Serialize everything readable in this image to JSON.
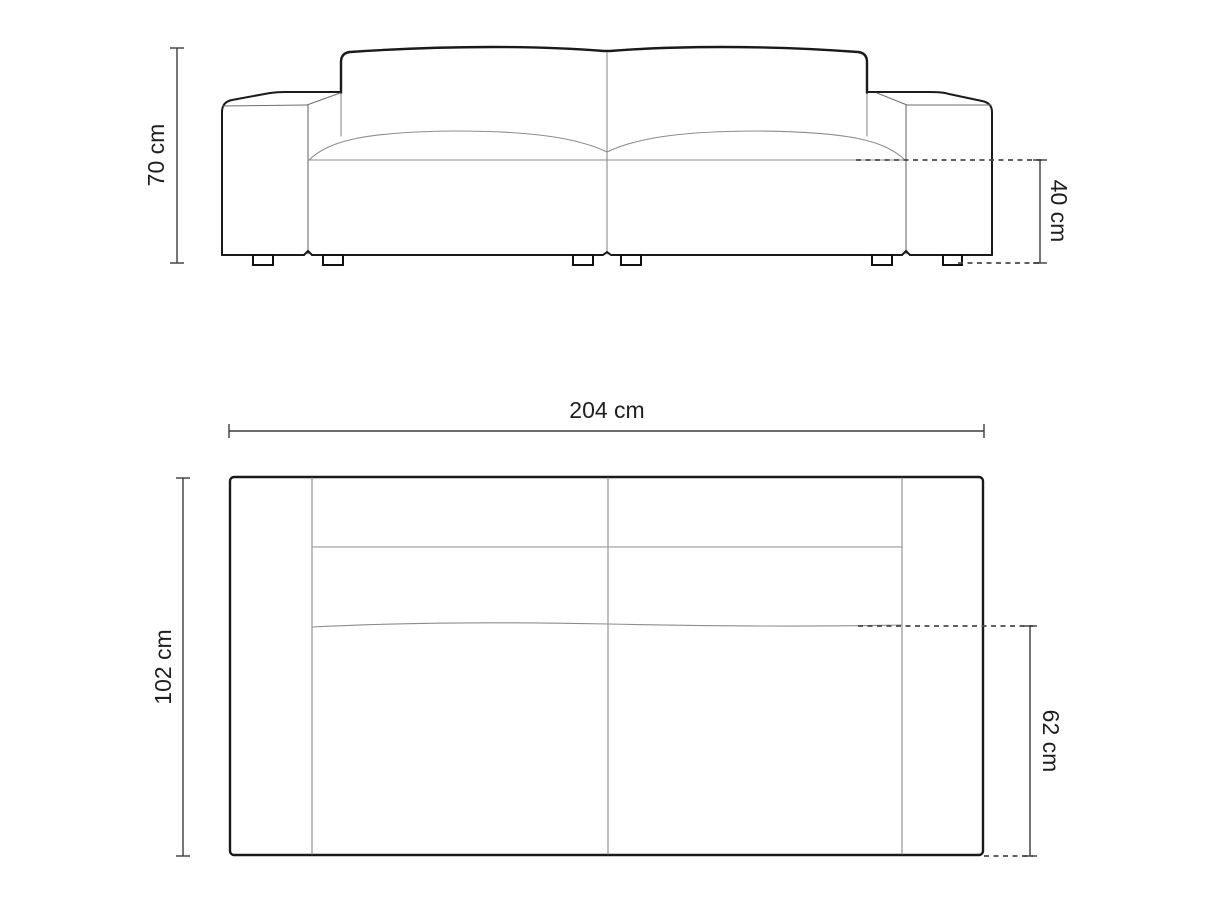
{
  "diagram": {
    "kind": "furniture-dimension-drawing",
    "views": [
      {
        "id": "front-view",
        "dimensions": [
          {
            "id": "overall-height",
            "label": "70 cm",
            "value": 70,
            "unit": "cm"
          },
          {
            "id": "seat-height",
            "label": "40 cm",
            "value": 40,
            "unit": "cm"
          }
        ]
      },
      {
        "id": "top-view",
        "dimensions": [
          {
            "id": "overall-width",
            "label": "204 cm",
            "value": 204,
            "unit": "cm"
          },
          {
            "id": "overall-depth",
            "label": "102 cm",
            "value": 102,
            "unit": "cm"
          },
          {
            "id": "seat-depth",
            "label": "62 cm",
            "value": 62,
            "unit": "cm"
          }
        ]
      }
    ],
    "colors": {
      "background": "#ffffff",
      "outline": "#1a1a1a",
      "seam": "#8d8d8d",
      "dimension_line": "#3c3c3c",
      "dashed_line": "#4a4a4a",
      "label_text": "#1f1f1f"
    }
  }
}
